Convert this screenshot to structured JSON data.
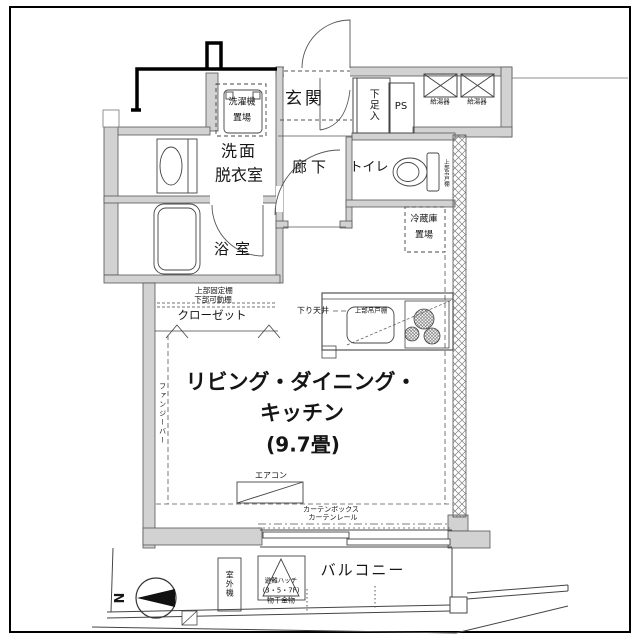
{
  "floorplan": {
    "colors": {
      "wall_fill": "#d2d2d2",
      "line": "#333333",
      "background": "#ffffff"
    },
    "rooms": {
      "genkan": "玄関",
      "hallway": "廊下",
      "toilet": "トイレ",
      "washroom_line1": "洗面",
      "washroom_line2": "脱衣室",
      "bathroom": "浴室",
      "closet": "クローゼット",
      "ldk_line1": "リビング・ダイニング・",
      "ldk_line2": "キッチン",
      "ldk_size": "(9.7畳)",
      "balcony": "バルコニー"
    },
    "fixtures": {
      "washer_line1": "洗濯機",
      "washer_line2": "置場",
      "shoe_box": "下足入",
      "pipe_space": "PS",
      "water_heater_1": "給湯器",
      "water_heater_2": "給湯器",
      "toilet_shelf": "上部吊戸棚",
      "fridge_line1": "冷蔵庫",
      "fridge_line2": "置場",
      "closet_shelf_top": "上部固定棚",
      "closet_shelf_bottom": "下部可動棚",
      "dropped_ceiling": "下り天井",
      "kitchen_cabinet": "上部吊戸棚",
      "side_label": "ファンジーバー",
      "aircon": "エアコン",
      "curtain_box": "カーテンボックス",
      "curtain_rail": "カーテンレール",
      "outdoor_unit": "室外機",
      "hatch_line1": "避難ハッチ",
      "hatch_line2": "(3・5・7F)",
      "laundry_hook": "物干金物"
    },
    "compass": {
      "north": "N"
    }
  }
}
